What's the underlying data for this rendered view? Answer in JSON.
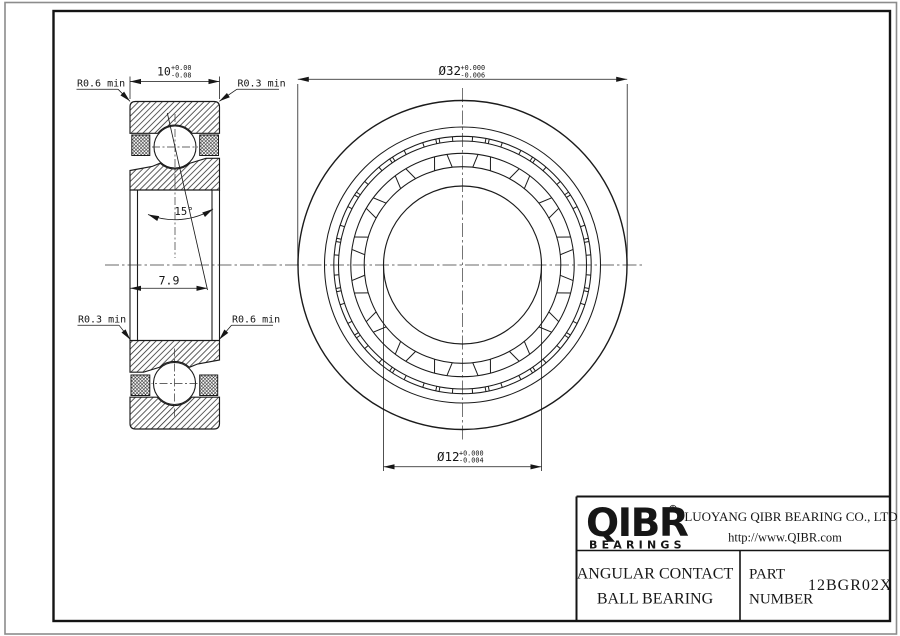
{
  "drawing": {
    "section": {
      "width_dim": {
        "value": "10",
        "tol_top": "+0.00",
        "tol_bottom": "-0.08"
      },
      "axial_dim": "7.9",
      "contact_angle": "15°",
      "radius_top_left": "R0.6 min",
      "radius_top_right": "R0.3 min",
      "radius_bottom_left": "R0.3 min",
      "radius_bottom_right": "R0.6 min"
    },
    "front": {
      "outer_dia": {
        "value": "Ø32",
        "tol_top": "+0.000",
        "tol_bottom": "-0.006"
      },
      "bore_dia": {
        "value": "Ø12",
        "tol_top": "+0.000",
        "tol_bottom": "-0.004"
      }
    }
  },
  "title_block": {
    "logo_text": "QIBR",
    "logo_reg": "®",
    "logo_subtext": "BEARINGS",
    "company_name": "LUOYANG QIBR BEARING CO., LTD",
    "website": "http://www.QIBR.com",
    "product_type_line1": "ANGULAR CONTACT",
    "product_type_line2": "BALL BEARING",
    "part_label_line1": "PART",
    "part_label_line2": "NUMBER",
    "part_number": "12BGR02X"
  }
}
